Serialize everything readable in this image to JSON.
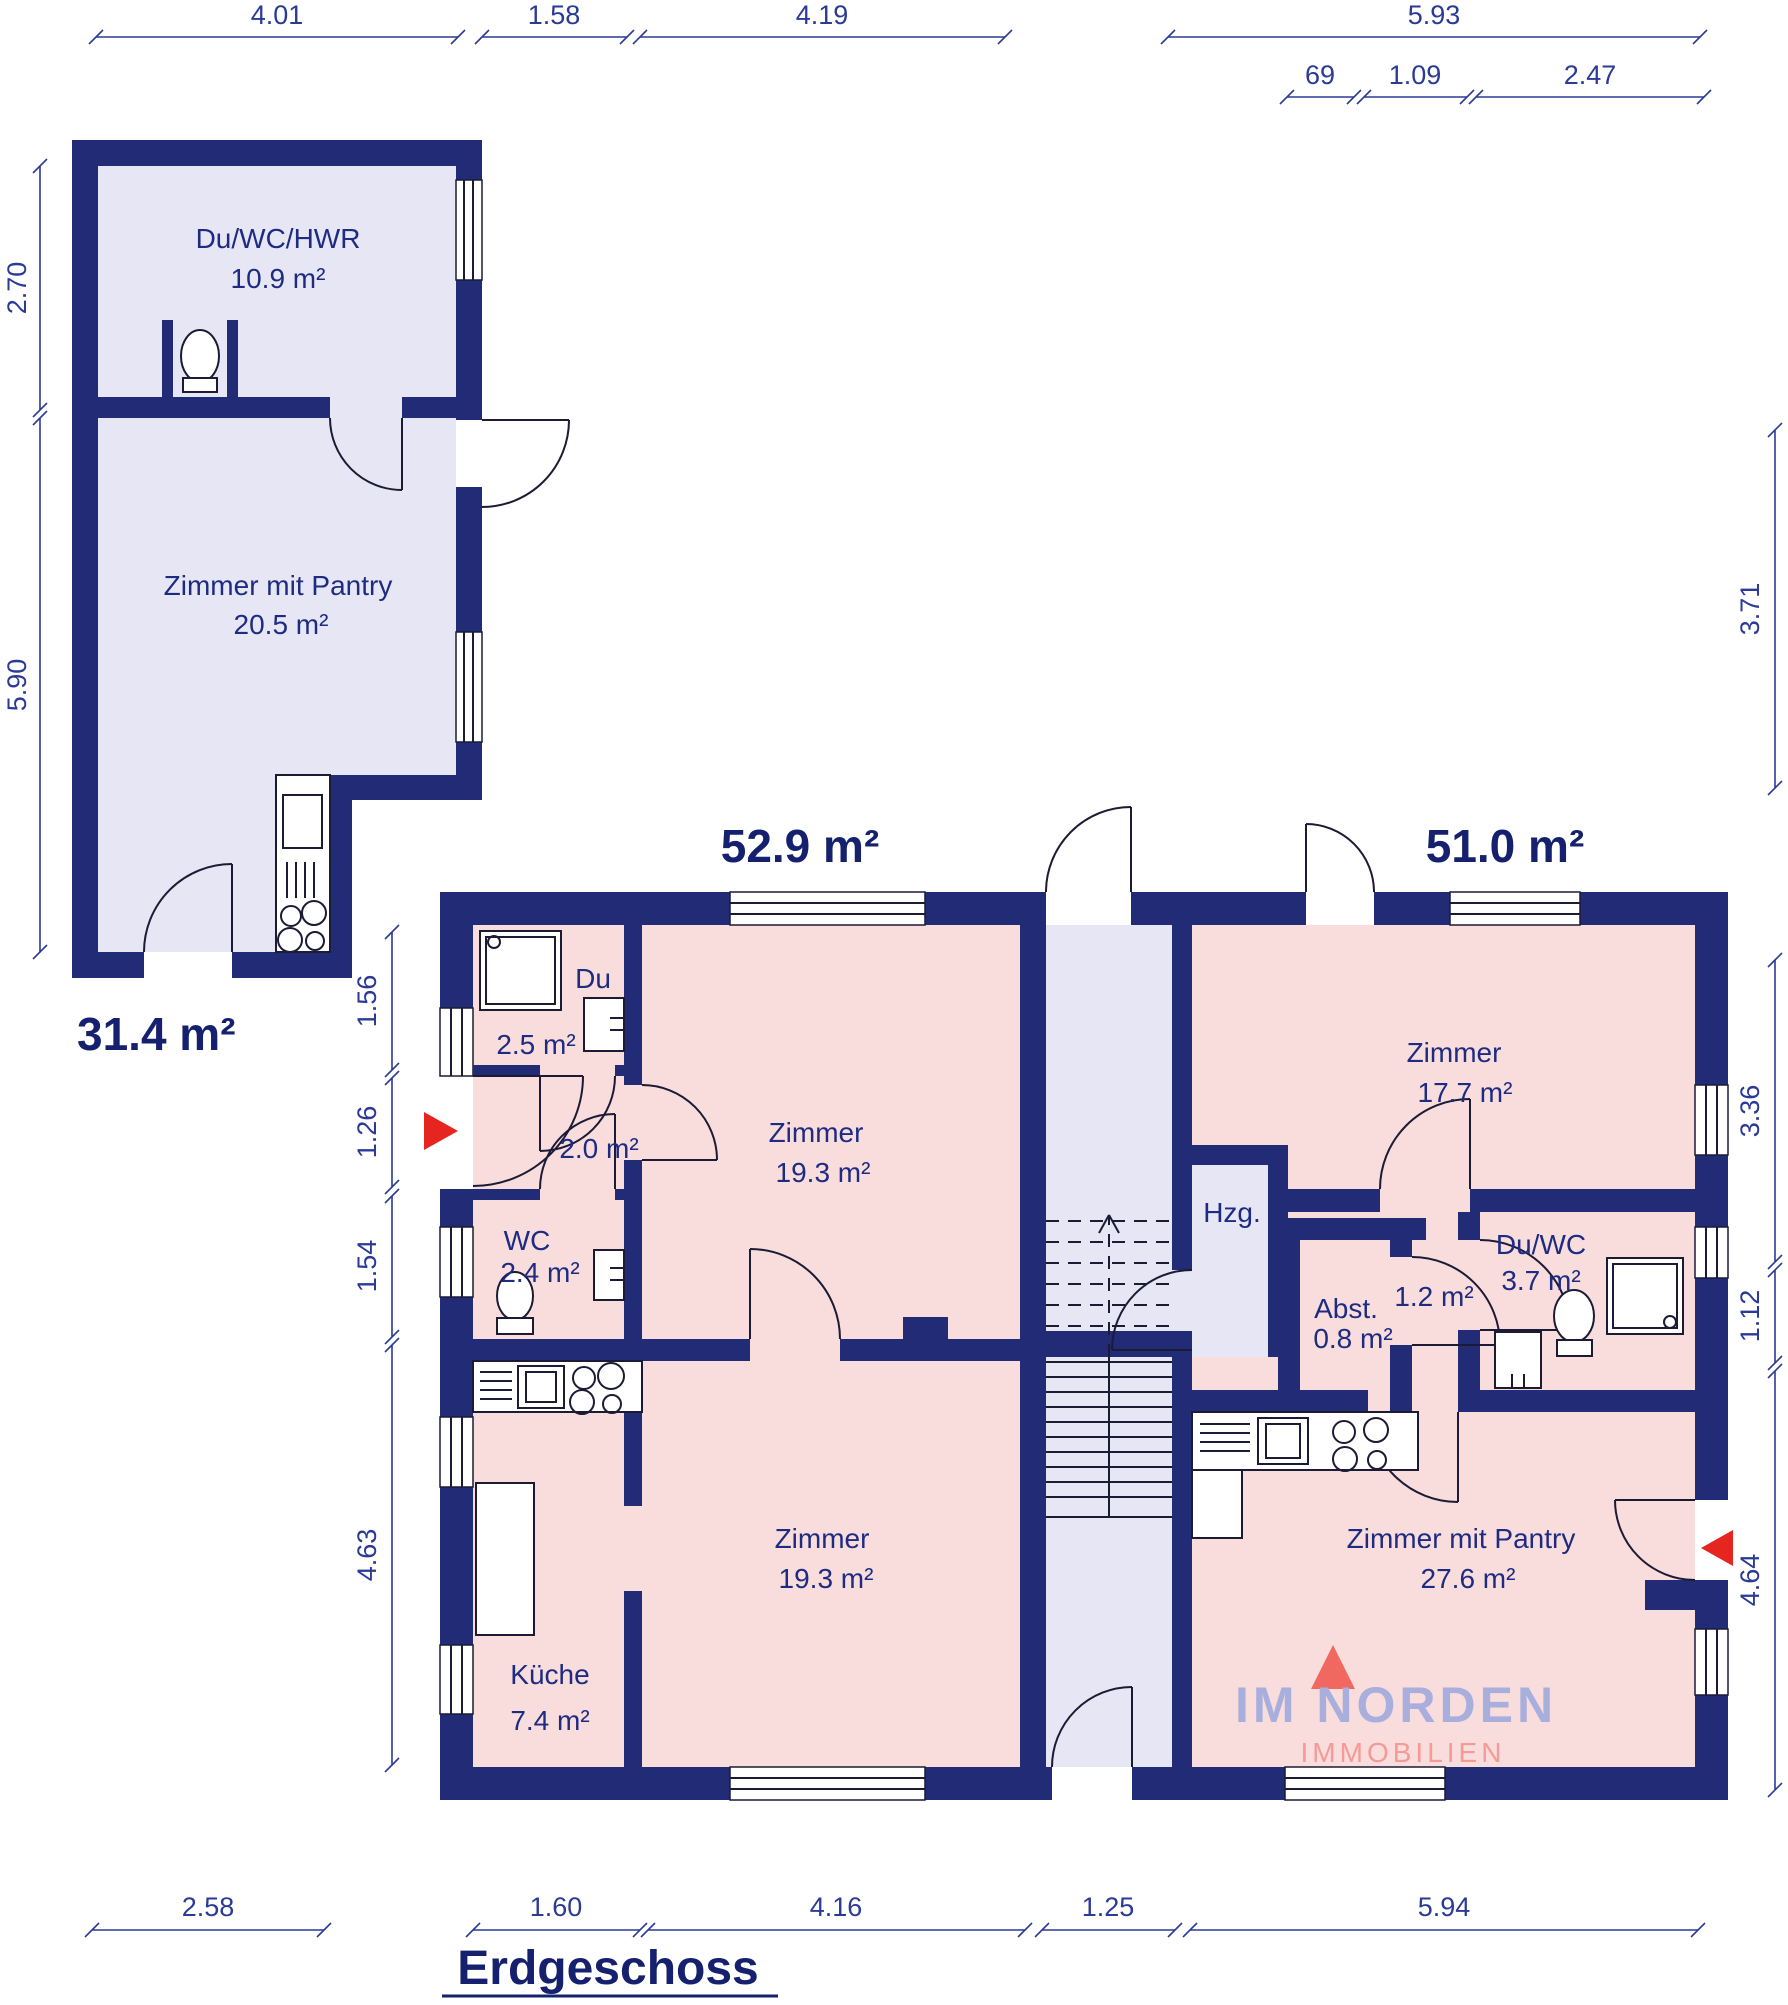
{
  "title": {
    "text": "Erdgeschoss"
  },
  "logo": {
    "name": "IM NORDEN",
    "subtitle": "IMMOBILIEN"
  },
  "units": {
    "annex": {
      "total_area": "31.4 m²",
      "rooms": [
        {
          "name": "Du/WC/HWR",
          "area": "10.9 m²"
        },
        {
          "name": "Zimmer mit Pantry",
          "area": "20.5 m²"
        }
      ]
    },
    "left_apartment": {
      "total_area": "52.9 m²",
      "rooms": [
        {
          "name": "Du",
          "area": "2.5 m²"
        },
        {
          "name": "",
          "area": "2.0 m²"
        },
        {
          "name": "WC",
          "area": "2.4 m²"
        },
        {
          "name": "Zimmer",
          "area": "19.3 m²"
        },
        {
          "name": "Zimmer",
          "area": "19.3 m²"
        },
        {
          "name": "Küche",
          "area": "7.4 m²"
        }
      ]
    },
    "right_apartment": {
      "total_area": "51.0 m²",
      "rooms": [
        {
          "name": "Zimmer",
          "area": "17.7 m²"
        },
        {
          "name": "Abst.",
          "area": "0.8 m²"
        },
        {
          "name": "",
          "area": "1.2 m²"
        },
        {
          "name": "Du/WC",
          "area": "3.7 m²"
        },
        {
          "name": "Zimmer mit Pantry",
          "area": "27.6 m²"
        }
      ]
    },
    "core": {
      "heating_label": "Hzg."
    }
  },
  "dimensions": {
    "top": [
      "4.01",
      "1.58",
      "4.19",
      "5.93"
    ],
    "top_sub": [
      "69",
      "1.09",
      "2.47"
    ],
    "annex_left": [
      "2.70",
      "5.90"
    ],
    "building_left": [
      "1.56",
      "1.26",
      "1.54",
      "4.63"
    ],
    "right": [
      "3.71",
      "3.36",
      "1.12",
      "4.64"
    ],
    "bottom": [
      "2.58",
      "1.60",
      "4.16",
      "1.25",
      "5.94"
    ]
  },
  "colors": {
    "wall": "#212b76",
    "room_pink": "#f9dcdc",
    "room_lavender": "#e6e6f4",
    "dimension_text": "#2b3a96",
    "label_text": "#1d2c82",
    "area_text": "#15206e",
    "entrance_arrow": "#e62520",
    "logo_name": "#a8afdd",
    "logo_subtitle": "#f49a97"
  }
}
